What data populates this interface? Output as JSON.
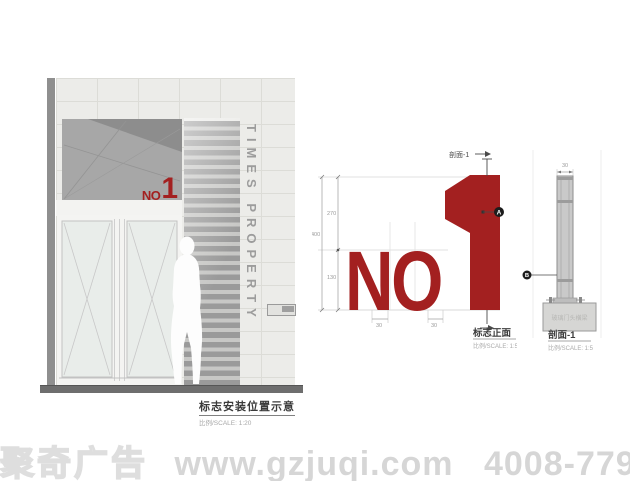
{
  "elevation_view": {
    "caption": "标志安装位置示意",
    "scale_label": "比例/SCALE: 1:20",
    "sign": {
      "no": "NO",
      "one": "1"
    },
    "louver_vertical_text": "TIMES PROPERTY"
  },
  "front_view": {
    "section_cut_label": "剖面-1",
    "sign": {
      "no": "NO",
      "one": "1"
    },
    "marker_a": "A",
    "dims": {
      "overall": "400",
      "upper": "270",
      "lower": "130",
      "left_stroke": "30",
      "right_stroke": "30"
    },
    "caption": "标志正面",
    "scale_label": "比例/SCALE: 1:5"
  },
  "section_view": {
    "dims": {
      "thickness": "30"
    },
    "marker_b": "B",
    "base_label": "玻璃门头横梁",
    "caption": "剖面-1",
    "scale_label": "比例/SCALE: 1:5"
  },
  "watermark": {
    "brand": "聚奇广告",
    "website": "www.gzjuqi.com",
    "phone": "4008-779-020"
  },
  "colors": {
    "sign_red": "#a32020",
    "watermark_gray": "#d6d6d6",
    "ground_gray": "#6e6e6e"
  }
}
